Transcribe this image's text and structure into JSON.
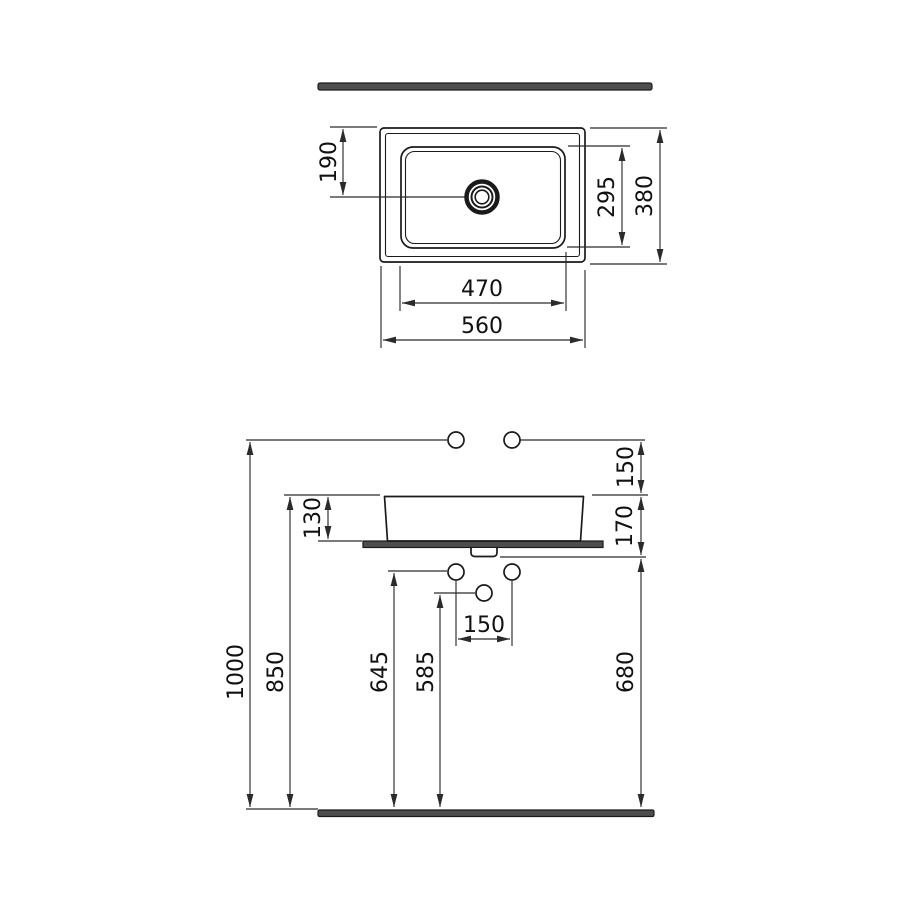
{
  "figure": {
    "description": "Countertop washbasin technical dimension drawing, plan view and front elevation",
    "units": "mm",
    "line_color": "#1a1a1a",
    "bar_color": "#4d4d4d",
    "background": "#ffffff"
  },
  "top_view": {
    "dim_drain_from_front": "190",
    "dim_inner_depth": "295",
    "dim_overall_depth": "380",
    "dim_inner_width": "470",
    "dim_overall_width": "560"
  },
  "front_view": {
    "dim_tap_above_rim": "150",
    "dim_basin_height": "130",
    "dim_rim_to_outlet": "170",
    "dim_tap_line_height": "1000",
    "dim_rim_height": "850",
    "dim_supply_hole_height": "645",
    "dim_drain_hole_height": "585",
    "dim_hole_spacing": "150",
    "dim_outlet_line_height": "680"
  }
}
